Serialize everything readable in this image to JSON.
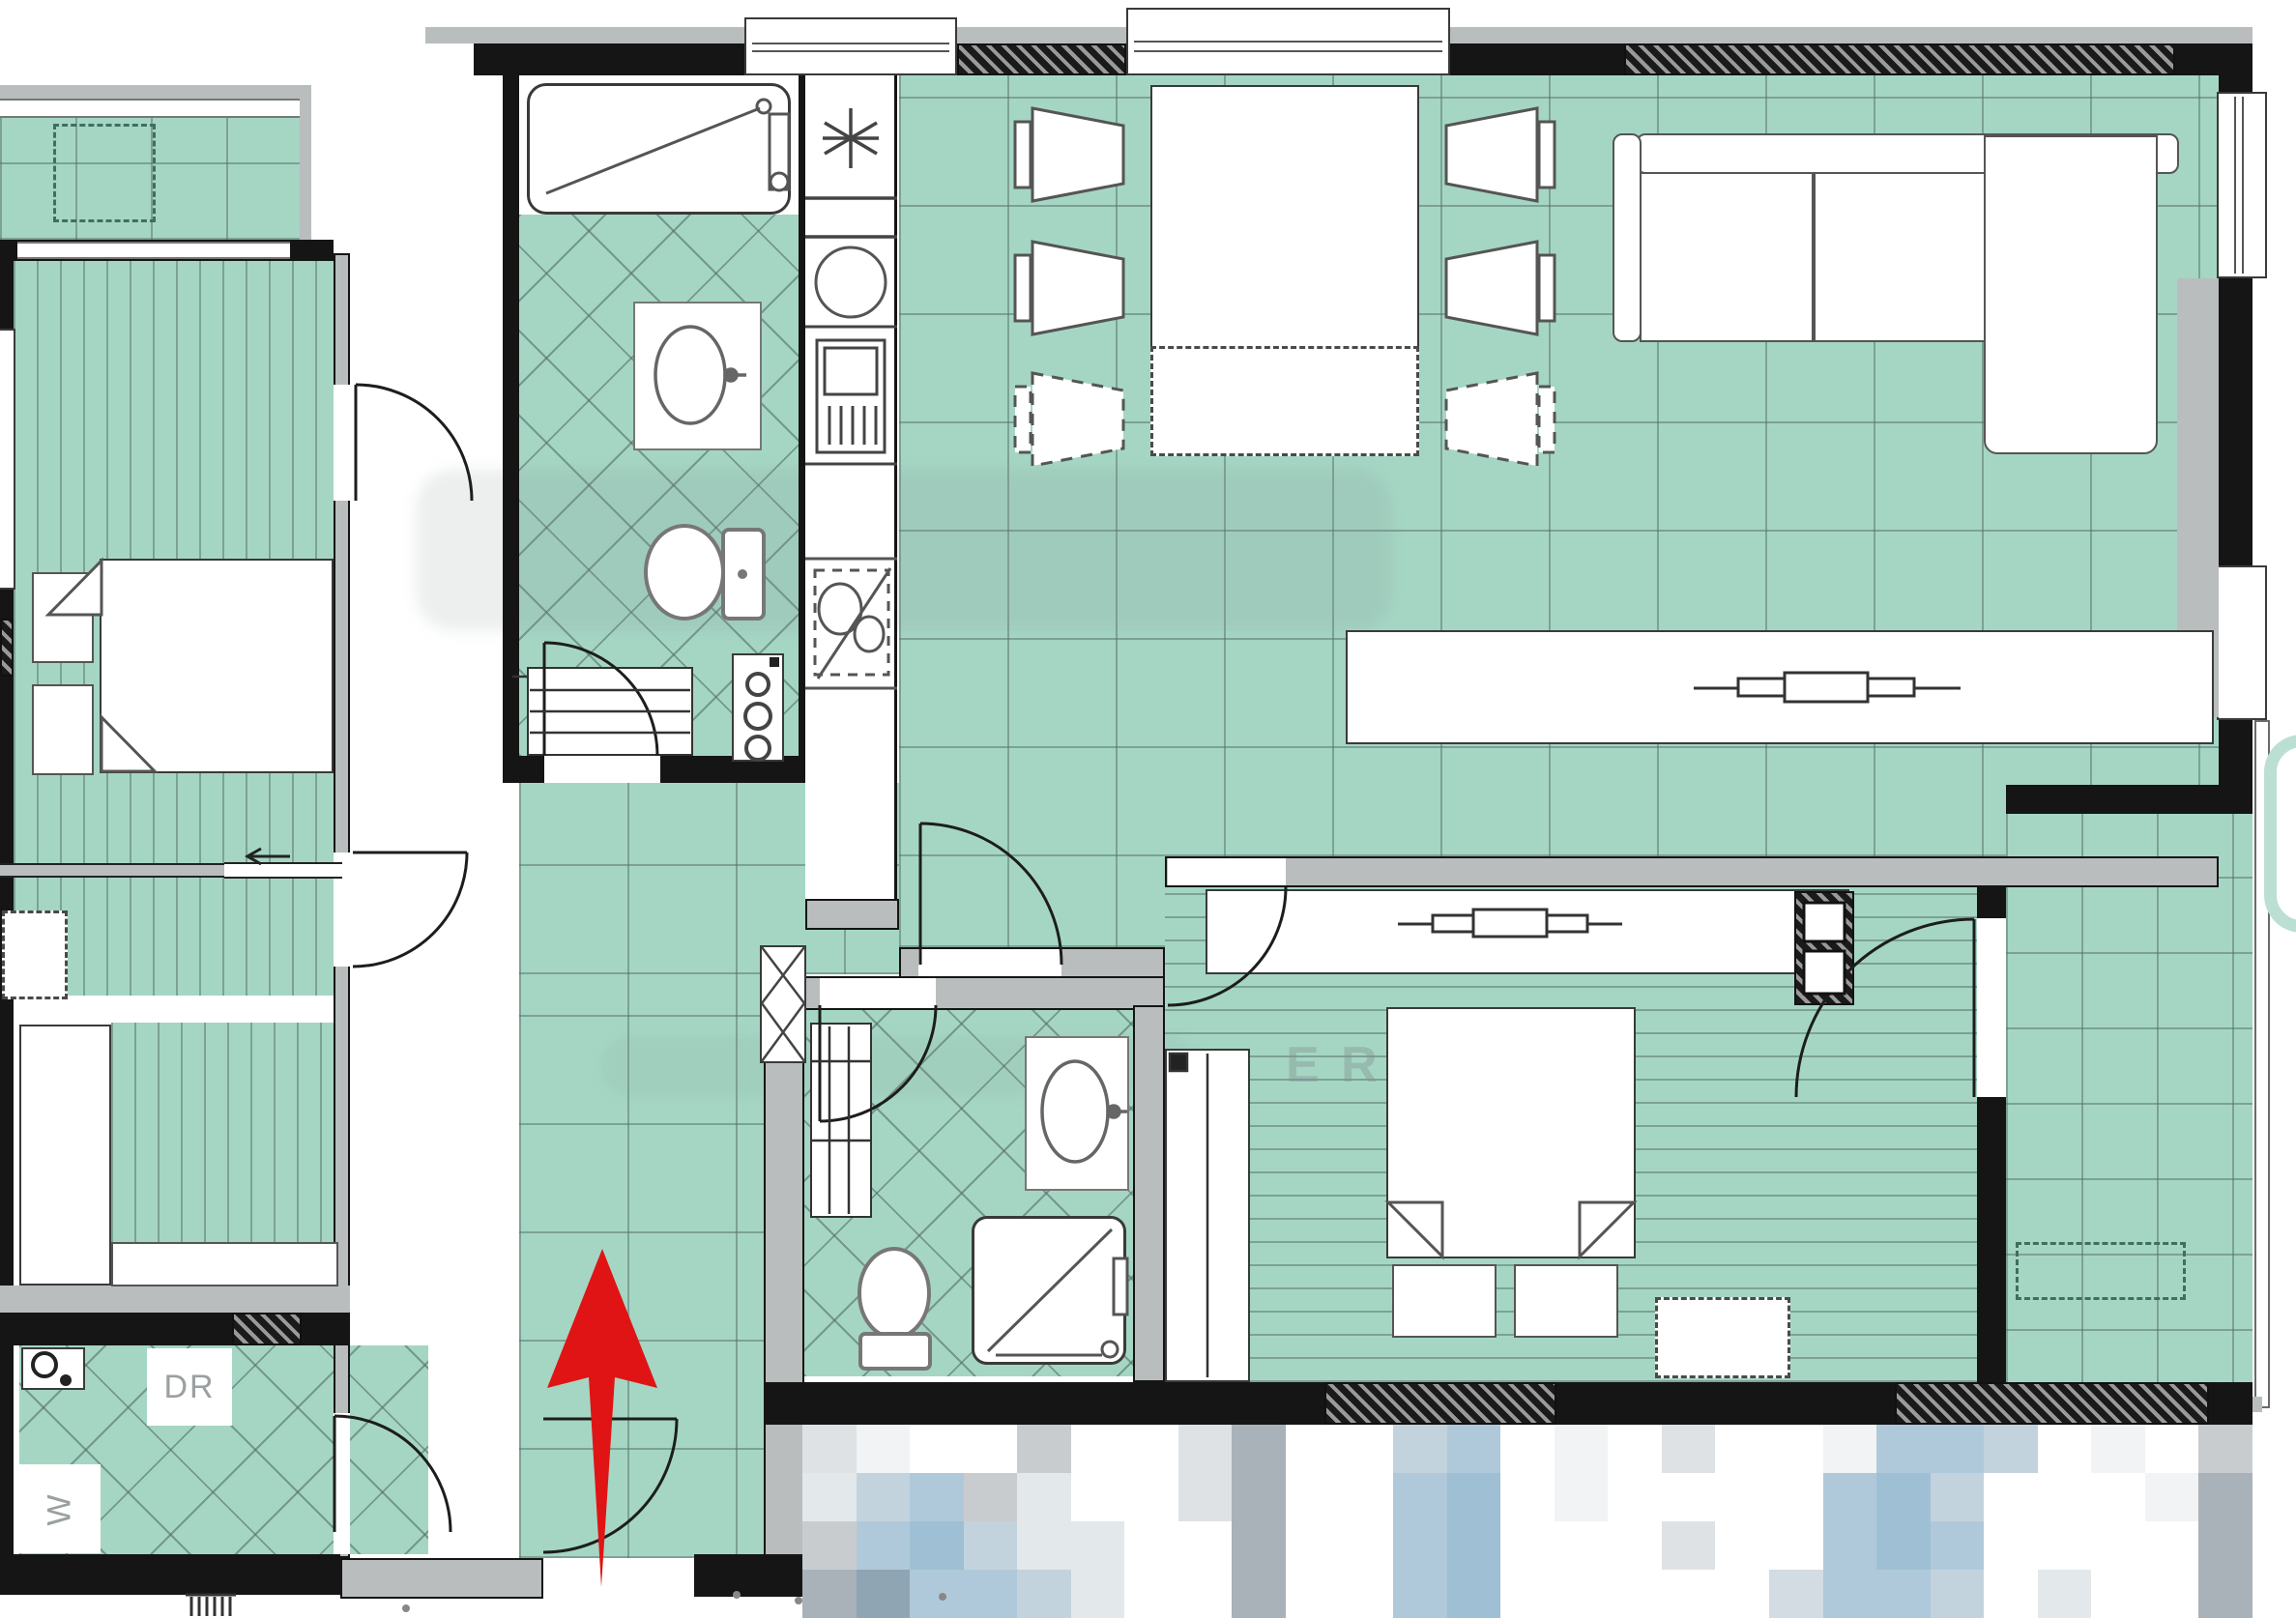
{
  "document": {
    "type": "apartment-floor-plan",
    "style": "2d-architectural-drawing"
  },
  "colors": {
    "floor_green": "#a5d6c4",
    "grout": "#5a7268",
    "wall_black": "#151515",
    "wall_gray": "#b9bdbd",
    "furniture_outline": "#3a3a3a",
    "entrance_arrow_red": "#e01414",
    "watermark_gray": "#8fa0a0",
    "landscape_accent": "#bcdfd4"
  },
  "labels": {
    "dryer": "DR",
    "washer": "W"
  },
  "watermark": {
    "fragment_left": "E",
    "fragment_right": "R"
  },
  "entrance_arrow": {
    "direction": "up",
    "meaning": "entrance"
  },
  "rooms": [
    {
      "name": "balcony-top-left",
      "floor": "square-tiles"
    },
    {
      "name": "bedroom-left",
      "floor": "wood-strips-vertical"
    },
    {
      "name": "dressing-area",
      "floor": "wood-strips-vertical"
    },
    {
      "name": "walk-in-closet",
      "floor": "wood-strips-vertical"
    },
    {
      "name": "utility-room",
      "floor": "diamond-tiles"
    },
    {
      "name": "bathroom-main",
      "floor": "diamond-tiles"
    },
    {
      "name": "kitchen-row",
      "floor": "white"
    },
    {
      "name": "living-dining-room",
      "floor": "square-tiles"
    },
    {
      "name": "hallway",
      "floor": "square-tiles"
    },
    {
      "name": "bathroom-second",
      "floor": "diamond-tiles"
    },
    {
      "name": "bedroom-master",
      "floor": "wood-strips-horizontal"
    },
    {
      "name": "balcony-right",
      "floor": "square-tiles"
    },
    {
      "name": "censored-area-bottom",
      "floor": "pixelated"
    }
  ],
  "fixtures": [
    "bathtub",
    "washbasin",
    "toilet",
    "towel-radiator",
    "meter-panel",
    "fridge-asterisk",
    "kitchen-sink",
    "oven",
    "cooktop",
    "dining-table-extendable",
    "dining-chairs-6",
    "corner-sofa",
    "tv-sideboard",
    "double-bed",
    "wardrobe",
    "dresser-tv",
    "chimney-shaft",
    "shower",
    "washer",
    "dryer",
    "utility-sink",
    "sliding-door-arrow"
  ],
  "mosaic": {
    "palette": {
      "w": "#ffffff",
      "f": "#f1f3f4",
      "e": "#e3e8ea",
      "d": "#d2dce2",
      "c": "#c2d3dd",
      "b": "#b0c9da",
      "B": "#9fbfd4",
      "g": "#c9ccce",
      "G": "#a9b2b8",
      "s": "#8fa5b4",
      "l": "#dfe2e4"
    },
    "rows": [
      "lfwwgwwlGwwcbwfwlwwfbbcwfwg",
      "ecbgewwlGwwbBwfwwwwbBcwwwfG",
      "gbBceewwGwwbBwwwlwwbBbwwwwG",
      "GsbbcewwGwwbBwwwwwdbbcwewwG"
    ]
  }
}
